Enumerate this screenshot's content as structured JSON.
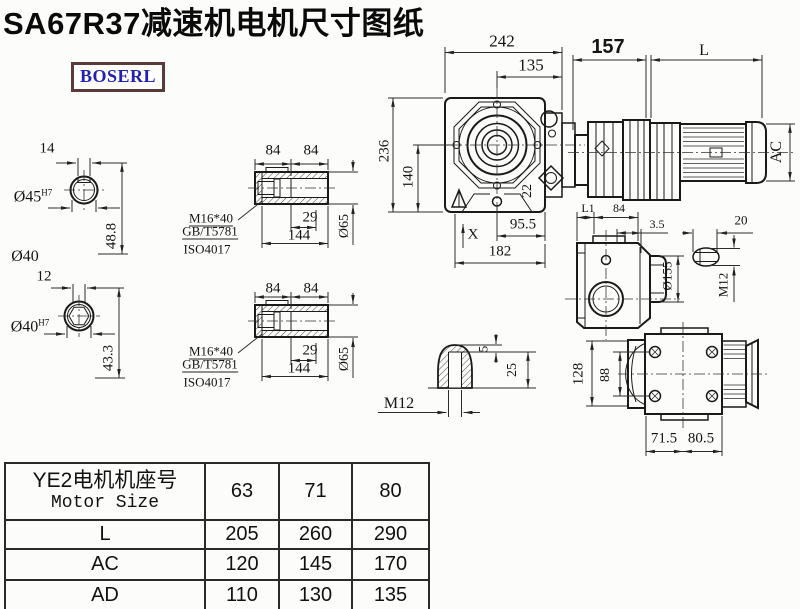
{
  "title": "SA67R37减速机电机尺寸图纸",
  "logo": {
    "text": "BOSERL",
    "text_color": "#2121b5",
    "border_color": "#5c3a3a"
  },
  "drawing": {
    "shaft_section_top": {
      "key_width": "14",
      "bore": "Ø45",
      "bore_tolerance": "H7",
      "depth": "48.8",
      "shaft_dia": "Ø40"
    },
    "shaft_section_bottom": {
      "key_width": "12",
      "bore": "Ø40",
      "bore_tolerance": "H7",
      "depth": "43.3"
    },
    "hollow_shaft_top": {
      "seg1": "84",
      "seg2": "84",
      "thread": "M16*40",
      "standard1": "GB/T5781",
      "standard2": "ISO4017",
      "step": "29",
      "length": "144",
      "dia": "Ø65"
    },
    "hollow_shaft_bottom": {
      "seg1": "84",
      "seg2": "84",
      "thread": "M16*40",
      "standard1": "GB/T5781",
      "standard2": "ISO4017",
      "step": "29",
      "length": "144",
      "dia": "Ø65"
    },
    "front_view": {
      "width": "242",
      "center_offset": "135",
      "height": "236",
      "axis_height": "140",
      "bolt": "22",
      "foot": "95.5",
      "base": "182",
      "marker": "X"
    },
    "motor_view": {
      "gear_length": "157",
      "motor_length": "L",
      "motor_dia": "AC"
    },
    "side_view": {
      "l1": "L1",
      "width": "84",
      "gap": "3.5",
      "flange_dia": "Ø155",
      "stud_width": "20",
      "stud_thread": "M12"
    },
    "rear_view": {
      "height": "128",
      "bolt_spacing": "88",
      "left": "71.5",
      "right": "80.5"
    },
    "plug_detail": {
      "tip": "5",
      "depth": "25",
      "thread": "M12"
    }
  },
  "table": {
    "header_cn": "YE2电机机座号",
    "header_en": "Motor Size",
    "columns": [
      "63",
      "71",
      "80"
    ],
    "rows": [
      {
        "label": "L",
        "values": [
          "205",
          "260",
          "290"
        ]
      },
      {
        "label": "AC",
        "values": [
          "120",
          "145",
          "170"
        ]
      },
      {
        "label": "AD",
        "values": [
          "110",
          "130",
          "135"
        ]
      }
    ]
  }
}
